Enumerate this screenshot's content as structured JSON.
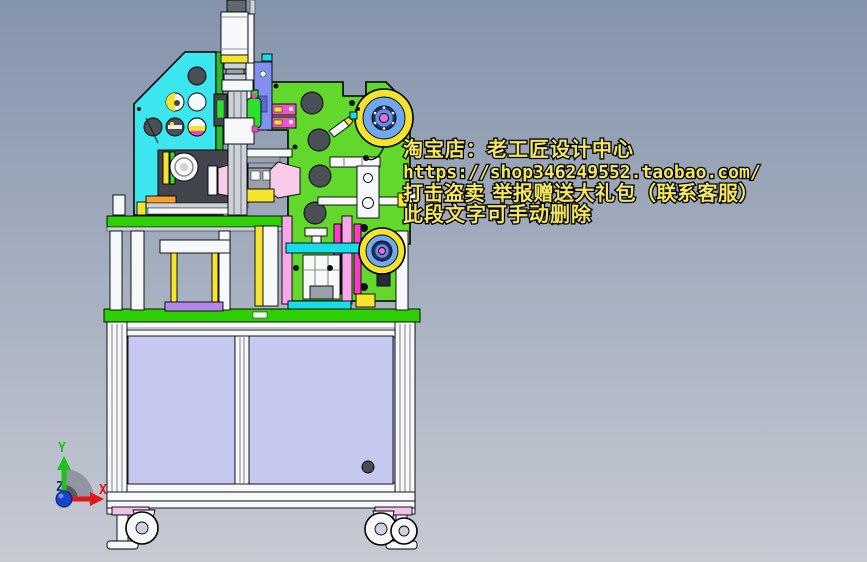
{
  "watermark": {
    "lines": [
      "淘宝店：老工匠设计中心",
      "https://shop346249552.taobao.com/",
      "打击盗卖 举报赠送大礼包（联系客服）",
      "此段文字可手动删除"
    ]
  },
  "axis_triad": {
    "x_label": "X",
    "y_label": "Y",
    "z_label": "Z"
  },
  "colors": {
    "bg_top": "#8494ab",
    "bg_bottom": "#c6cad3",
    "cyan_plate": "#3ce6ee",
    "green_plate": "#63d82c",
    "deck_green": "#2fcf06",
    "edge_green": "#2db82d",
    "bottle_green": "#2ee02e",
    "reel_rim": "#f4e32e",
    "reel_disc": "#70a8f0",
    "reel_navy": "#1f3070",
    "reel_hub": "#5b8fe8",
    "reel_center": "#f468d8",
    "cabinet_panel": "#c6c8f0",
    "frame_white": "#f6f8fa",
    "foot_pad": "#f0c0ea",
    "col_yellow": "#f4e430",
    "col_pink": "#f8a8e8",
    "col_magenta": "#f83cc8",
    "pad_purple": "#b583ea",
    "block_blue": "#8090f0",
    "block_orange": "#f6a02e",
    "horn_pink": "#f8cce8",
    "motor_dark": "#42454c",
    "hole_dark": "#4a4e55",
    "watermark_fill": "#f4e55e",
    "axis_x": "#e01818",
    "axis_y": "#20c020",
    "axis_z": "#15307f"
  }
}
